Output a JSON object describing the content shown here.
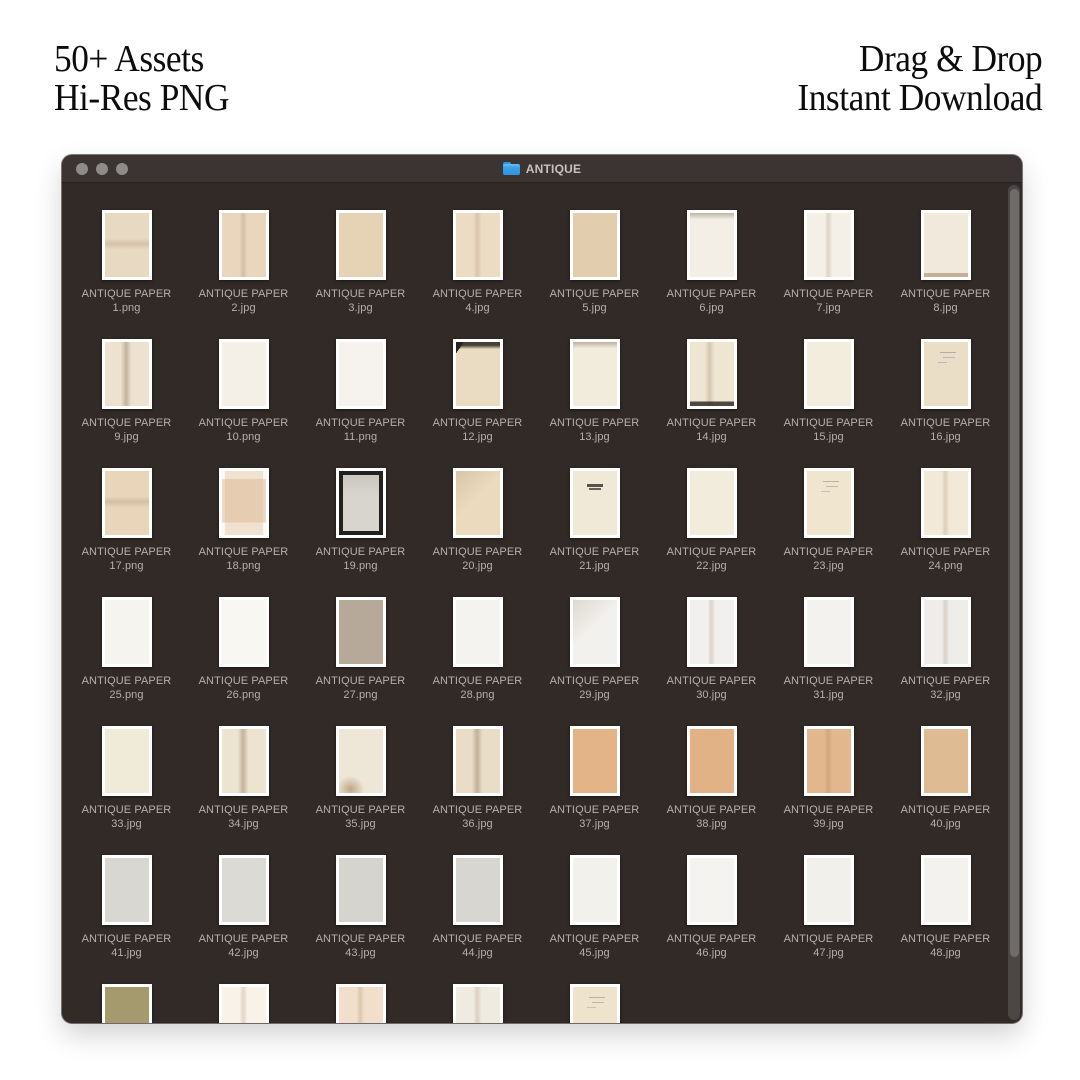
{
  "header": {
    "left_line1": "50+ Assets",
    "left_line2": "Hi-Res PNG",
    "right_line1": "Drag & Drop",
    "right_line2": "Instant Download"
  },
  "window": {
    "title": "ANTIQUE",
    "folder_icon": "blue-folder-icon",
    "traffic_lights": {
      "color": "#8f8b89",
      "count": 3
    },
    "colors": {
      "content_bg": "#322a27",
      "titlebar_bg": "#3b3433",
      "label_text": "#b4b0ad",
      "title_text": "#c6c2c0",
      "folder_blue": "#3da0e8",
      "scroll_track": "#4c4644",
      "scroll_thumb": "#6f6b69"
    },
    "item_label": "ANTIQUE PAPER",
    "items": [
      {
        "file": "1.png",
        "color": "#e8d9c2",
        "variant": "fold-h"
      },
      {
        "file": "2.jpg",
        "color": "#e9d6bd",
        "variant": "fold-v"
      },
      {
        "file": "3.jpg",
        "color": "#e6d2b4",
        "variant": ""
      },
      {
        "file": "4.jpg",
        "color": "#ecdcc4",
        "variant": "fold-v"
      },
      {
        "file": "5.jpg",
        "color": "#e3cdaf",
        "variant": ""
      },
      {
        "file": "6.jpg",
        "color": "#f3efe6",
        "variant": "torn-top"
      },
      {
        "file": "7.jpg",
        "color": "#f4f0e7",
        "variant": "fold-v"
      },
      {
        "file": "8.jpg",
        "color": "#f1e9dc",
        "variant": "torn-bottom"
      },
      {
        "file": "9.jpg",
        "color": "#ece2cf",
        "variant": "fold-v-strong"
      },
      {
        "file": "10.png",
        "color": "#f4f0e8",
        "variant": ""
      },
      {
        "file": "11.png",
        "color": "#f6f3ee",
        "variant": ""
      },
      {
        "file": "12.jpg",
        "color": "#e9dcc3",
        "variant": "torn-top-dark"
      },
      {
        "file": "13.jpg",
        "color": "#f2ecdd",
        "variant": "torn-top"
      },
      {
        "file": "14.jpg",
        "color": "#eee5d2",
        "variant": "bottom-dark"
      },
      {
        "file": "15.jpg",
        "color": "#f3eddd",
        "variant": ""
      },
      {
        "file": "16.jpg",
        "color": "#eadfc6",
        "variant": "hand"
      },
      {
        "file": "17.png",
        "color": "#e8d5ba",
        "variant": "fold-h"
      },
      {
        "file": "18.png",
        "color": "#fbf9f6",
        "variant": "envelope"
      },
      {
        "file": "19.png",
        "color": "#d8d5ce",
        "variant": "dark-frame"
      },
      {
        "file": "20.jpg",
        "color": "#ecdabe",
        "variant": "grad-corner"
      },
      {
        "file": "21.jpg",
        "color": "#f0e9d8",
        "variant": "text-block"
      },
      {
        "file": "22.jpg",
        "color": "#f2ecdc",
        "variant": ""
      },
      {
        "file": "23.jpg",
        "color": "#f0e6d0",
        "variant": "hand"
      },
      {
        "file": "24.png",
        "color": "#f3e9d8",
        "variant": "fold-v"
      },
      {
        "file": "25.png",
        "color": "#f6f4ee",
        "variant": ""
      },
      {
        "file": "26.png",
        "color": "#f9f7f2",
        "variant": ""
      },
      {
        "file": "27.png",
        "color": "#b7a99a",
        "variant": ""
      },
      {
        "file": "28.png",
        "color": "#f5f3ef",
        "variant": ""
      },
      {
        "file": "29.jpg",
        "color": "#f3f1ed",
        "variant": "grad-corner"
      },
      {
        "file": "30.jpg",
        "color": "#f2f0ec",
        "variant": "fold-v"
      },
      {
        "file": "31.jpg",
        "color": "#f4f2ef",
        "variant": ""
      },
      {
        "file": "32.jpg",
        "color": "#efedea",
        "variant": "fold-v"
      },
      {
        "file": "33.jpg",
        "color": "#f0ead9",
        "variant": ""
      },
      {
        "file": "34.jpg",
        "color": "#ece3d0",
        "variant": "fold-v-strong"
      },
      {
        "file": "35.jpg",
        "color": "#eee6d6",
        "variant": "stain"
      },
      {
        "file": "36.jpg",
        "color": "#e9ddc8",
        "variant": "fold-v-strong"
      },
      {
        "file": "37.jpg",
        "color": "#e3b488",
        "variant": ""
      },
      {
        "file": "38.jpg",
        "color": "#e0b285",
        "variant": ""
      },
      {
        "file": "39.jpg",
        "color": "#e2b78d",
        "variant": "fold-v"
      },
      {
        "file": "40.jpg",
        "color": "#debb92",
        "variant": ""
      },
      {
        "file": "41.jpg",
        "color": "#d9d7d2",
        "variant": ""
      },
      {
        "file": "42.jpg",
        "color": "#dcdad5",
        "variant": ""
      },
      {
        "file": "43.jpg",
        "color": "#d6d4cf",
        "variant": ""
      },
      {
        "file": "44.jpg",
        "color": "#d8d6d1",
        "variant": ""
      },
      {
        "file": "45.jpg",
        "color": "#f2f1ec",
        "variant": ""
      },
      {
        "file": "46.jpg",
        "color": "#f4f3ef",
        "variant": ""
      },
      {
        "file": "47.jpg",
        "color": "#f1f0eb",
        "variant": ""
      },
      {
        "file": "48.jpg",
        "color": "#f3f2ee",
        "variant": ""
      },
      {
        "file": null,
        "color": "#a59a6d",
        "variant": ""
      },
      {
        "file": null,
        "color": "#f9f2e8",
        "variant": "fold-v"
      },
      {
        "file": null,
        "color": "#f2dfcb",
        "variant": "fold-v"
      },
      {
        "file": null,
        "color": "#f0ebe0",
        "variant": "fold-v"
      },
      {
        "file": null,
        "color": "#eee4cb",
        "variant": "hand"
      }
    ]
  }
}
